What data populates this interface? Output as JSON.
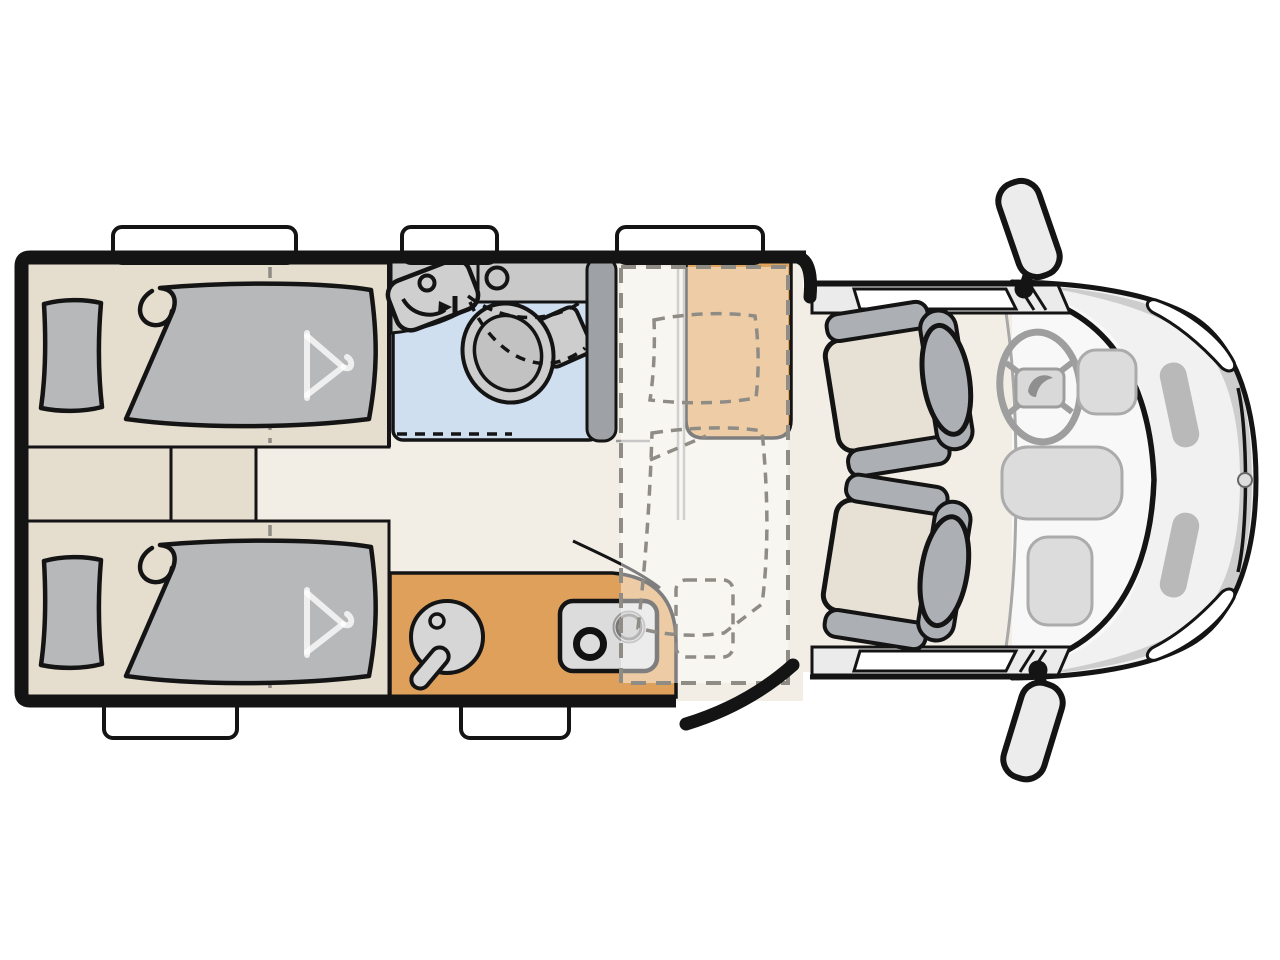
{
  "diagram": {
    "type": "Motorhome floor plan, top view",
    "areas": [
      {
        "name": "rear-twin-bed-top",
        "desc": "Single bed with pillow, folded duvet and dashed under-bed wardrobe divider with hanger symbol"
      },
      {
        "name": "rear-twin-bed-bottom",
        "desc": "Single bed with pillow, folded duvet and dashed under-bed wardrobe divider with hanger symbol"
      },
      {
        "name": "center-step-cabinet",
        "desc": "Low cabinet / step between the two rear beds"
      },
      {
        "name": "bathroom",
        "desc": "Swivel washbasin with rotation arrow, corner shelf, toilet, blue shower floor, dashed folding shower screen"
      },
      {
        "name": "wardrobe-column",
        "desc": "Tall dark cabinet between bathroom and dinette"
      },
      {
        "name": "dinette-bench",
        "desc": "Orange upholstered travel bench"
      },
      {
        "name": "drop-down-bed",
        "desc": "Dashed overlay rectangle with pillow and duvet indicating lowering bed over dinette"
      },
      {
        "name": "folding-table",
        "desc": "Small dashed rounded rectangle next to kitchen"
      },
      {
        "name": "kitchen",
        "desc": "Orange counter with round sink, faucet and two-burner hob"
      },
      {
        "name": "entry-door",
        "desc": "Open entry door drawn swung outwards at lower right of habitat"
      },
      {
        "name": "cab",
        "desc": "Vehicle cab with two rear-facing swivel seats, steering wheel, dashboard consoles, headlights and two exterior mirrors"
      }
    ],
    "window_count": 5,
    "seat_count": 2
  },
  "colors": {
    "wall": "#141414",
    "floor": "#F3EEE5",
    "platform": "#E5DDCE",
    "mattress": "#B6B8BA",
    "bench_orange": "#E0A45E",
    "kitchen_orange": "#DFA05C",
    "shower_blue": "#CFDFF0",
    "fixture_gray": "#CCCCCC",
    "wardrobe_gray": "#9EA1A5",
    "overlay_dash": "#8F8C86",
    "overlay_duvet": "#C9C5BE",
    "overlay_pillow": "#CCC8C1",
    "cab_body": "#F1F1F1",
    "cab_shadow": "#CDCDCD",
    "seat_cushion": "#E7E1D5",
    "seat_trim": "#ACAFB3",
    "dash_gray": "#DCDCDC",
    "hanger_white": "rgba(255,255,255,0.78)"
  }
}
